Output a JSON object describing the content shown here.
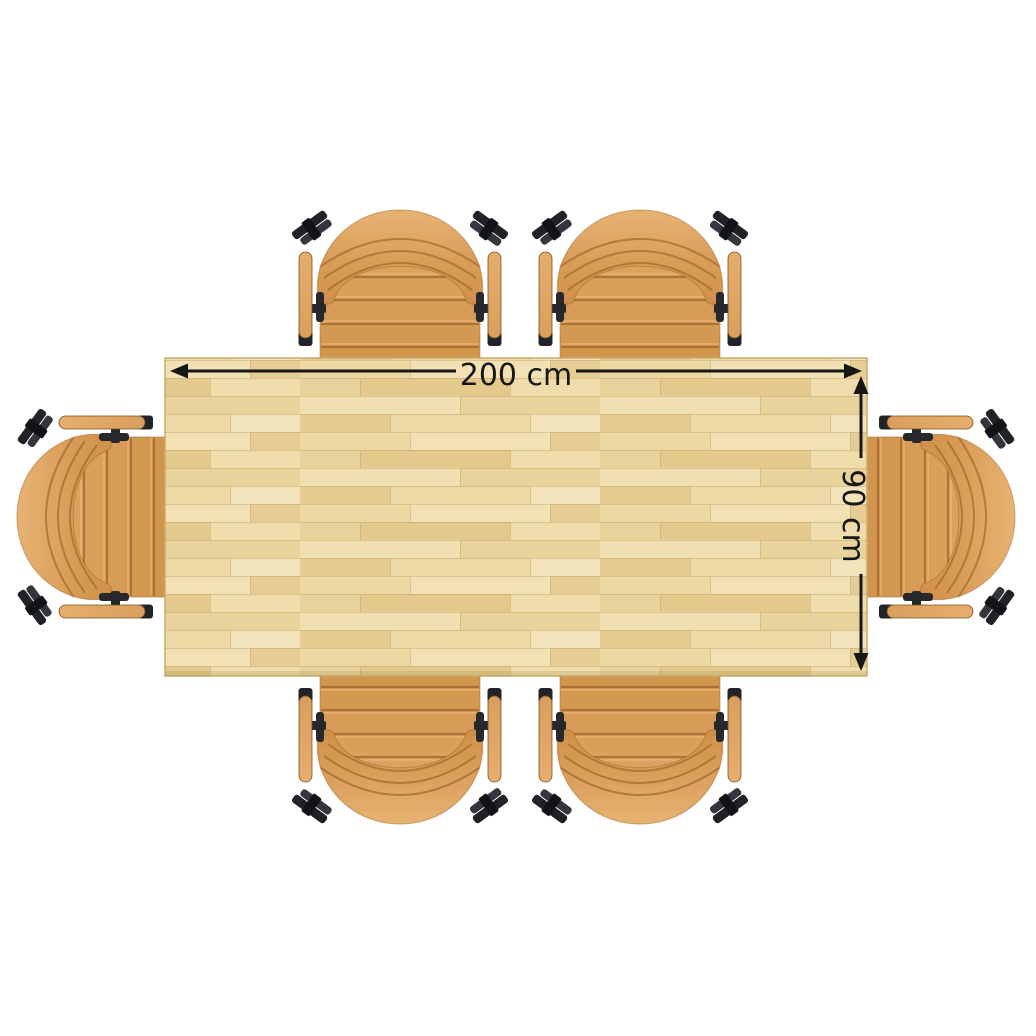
{
  "page": {
    "background_color": "#ffffff",
    "view": "top-down furniture plan of a rectangular table with six armchairs"
  },
  "table": {
    "name": "rectangular dining table top",
    "width_label": "200 cm",
    "depth_label": "90 cm",
    "width_cm": 200,
    "depth_cm": 90,
    "surface": "light wood butcher block",
    "wood_tones": [
      "#f1e1b5",
      "#ecd8a2",
      "#e6cd94",
      "#e3c98c"
    ],
    "edge_color": "#c9ab6c"
  },
  "chairs": {
    "count": 6,
    "arrangement": {
      "top": 2,
      "bottom": 2,
      "left": 1,
      "right": 1
    },
    "positions": [
      "top-left",
      "top-right",
      "bottom-left",
      "bottom-right",
      "left",
      "right"
    ],
    "upholstery_color": "#d89a53",
    "armrest_color": "#e2a866",
    "stitch_color": "#a36c30",
    "hardware_color": "#26282c"
  },
  "annotations": {
    "color": "#161616",
    "width": {
      "label": "200 cm",
      "orientation": "horizontal",
      "position": "top edge of table"
    },
    "depth": {
      "label": "90 cm",
      "orientation": "vertical",
      "position": "right edge of table"
    }
  }
}
